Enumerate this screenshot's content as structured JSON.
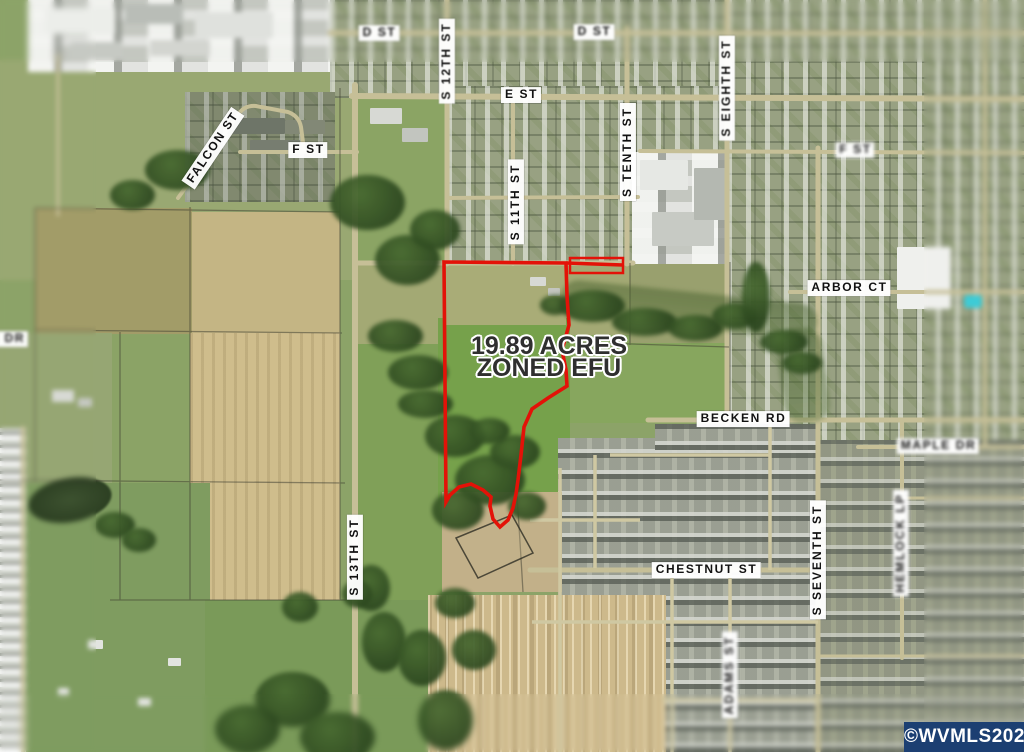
{
  "map": {
    "annotation": {
      "line1": "19.89 ACRES",
      "line2": "ZONED EFU"
    },
    "streets": {
      "d_st_w": "D ST",
      "d_st_e": "D ST",
      "s_12th_st": "S 12TH ST",
      "e_st": "E ST",
      "s_11th_st": "S 11TH ST",
      "s_tenth_st": "S TENTH ST",
      "s_eighth_st": "S EIGHTH ST",
      "falcon_st": "FALCON ST",
      "f_st_w": "F ST",
      "f_st_e": "F ST",
      "arbor_ct": "ARBOR CT",
      "becken_rd": "BECKEN RD",
      "maple_dr": "MAPLE DR",
      "s_seventh_st": "S SEVENTH ST",
      "hemlock_lp": "HEMLOCK LP",
      "s_13th_st": "S 13TH ST",
      "chestnut_st": "CHESTNUT ST",
      "adams_st": "ADAMS ST",
      "e_dr_partial": "E DR"
    },
    "colors": {
      "boundary": "#e31208",
      "label_bg": "#ffffff",
      "label_text": "#111111",
      "annotation_text": "#2f2f2f",
      "annotation_halo": "#ffffff",
      "watermark_bg": "#1c3f72",
      "watermark_text": "#ffffff"
    }
  },
  "watermark": {
    "text": "©WVMLS2026"
  }
}
